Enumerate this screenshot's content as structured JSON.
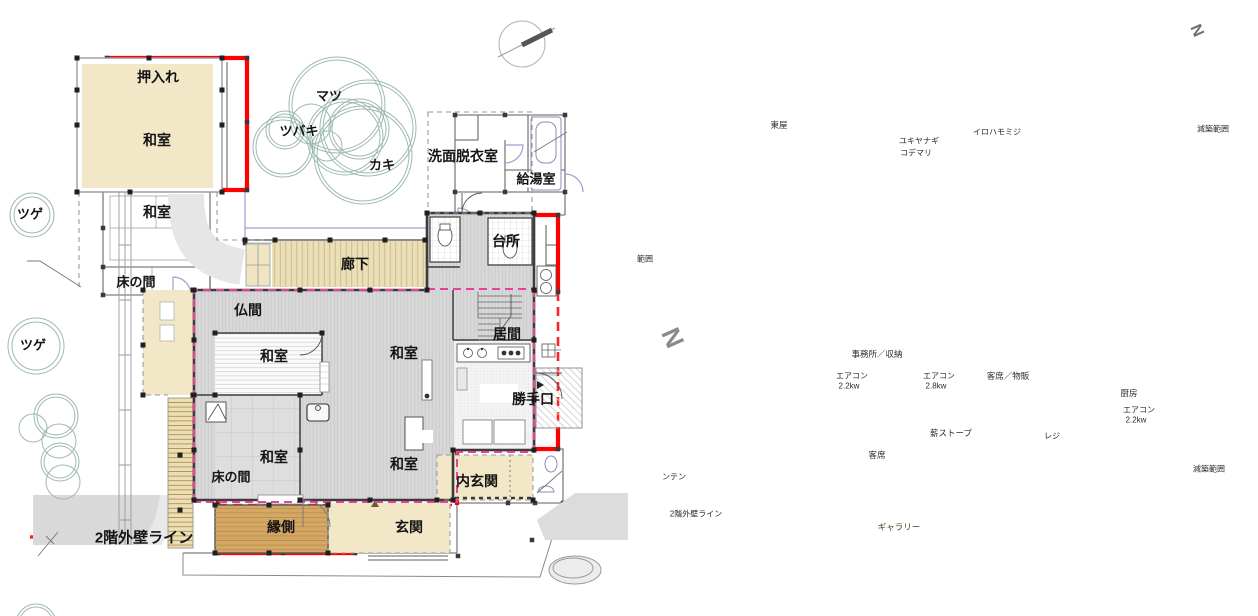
{
  "left_plan": {
    "labels": {
      "oshiire": "押入れ",
      "washitsu": "和室",
      "tokonoma": "床の間",
      "tsuge": "ツゲ",
      "matsu": "マツ",
      "tsubaki": "ツバキ",
      "kaki": "カキ",
      "senmen_datsuiishitsu": "洗面脱衣室",
      "kyutoshitsu": "給湯室",
      "daidokoro": "台所",
      "rouka": "廊下",
      "butsuma": "仏間",
      "ima": "居間",
      "katteguchi": "勝手口",
      "uchigenkan": "内玄関",
      "engawa": "縁側",
      "genkan": "玄関"
    },
    "legend": {
      "nikai_gaiheki_line": "2階外壁ライン"
    }
  },
  "right_plan": {
    "labels": {
      "azumaya": "東屋",
      "yukiyanagi": "ユキヤナギ",
      "kodemari": "コデマリ",
      "irohamomiji": "イロハモミジ",
      "genchiku_hanni": "減築範囲",
      "hanni_partial": "範囲",
      "nanten_partial": "ンテン",
      "jimusho_shunou": "事務所／収納",
      "aircon": "エアコン",
      "kw22": "2.2kw",
      "kw28": "2.8kw",
      "kyakuseki_buppan": "客席／物販",
      "maki_stove": "薪ストーブ",
      "kyakuseki": "客席",
      "reji": "レジ",
      "chubo": "厨房",
      "gallery": "ギャラリー",
      "nikai_gaiheki_line": "2階外壁ライン",
      "north_mark": "N"
    }
  },
  "colors": {
    "outline_red": "#ff0000",
    "red_dashed": "#ff2222",
    "pink_dashed": "#e8419a",
    "tree_stroke": "#9eb9b1",
    "beige_fill": "#f2e7c6",
    "deck_beige": "#eadfb6",
    "gallery_brown": "#d4a765",
    "interior_gray": "#d8d8d8",
    "wall_dark": "#3c3c3c",
    "door_purple": "#a49bd2"
  }
}
